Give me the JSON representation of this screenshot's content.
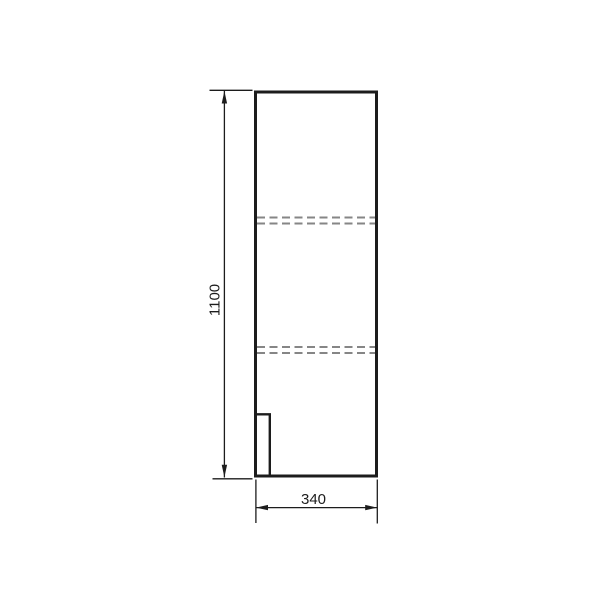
{
  "drawing": {
    "background": "#ffffff",
    "colors": {
      "line": "#1c1c1c",
      "hidden_line": "#868686",
      "text": "#1c1c1c"
    },
    "dimensions": {
      "height_label": "1100",
      "width_label": "340"
    }
  }
}
